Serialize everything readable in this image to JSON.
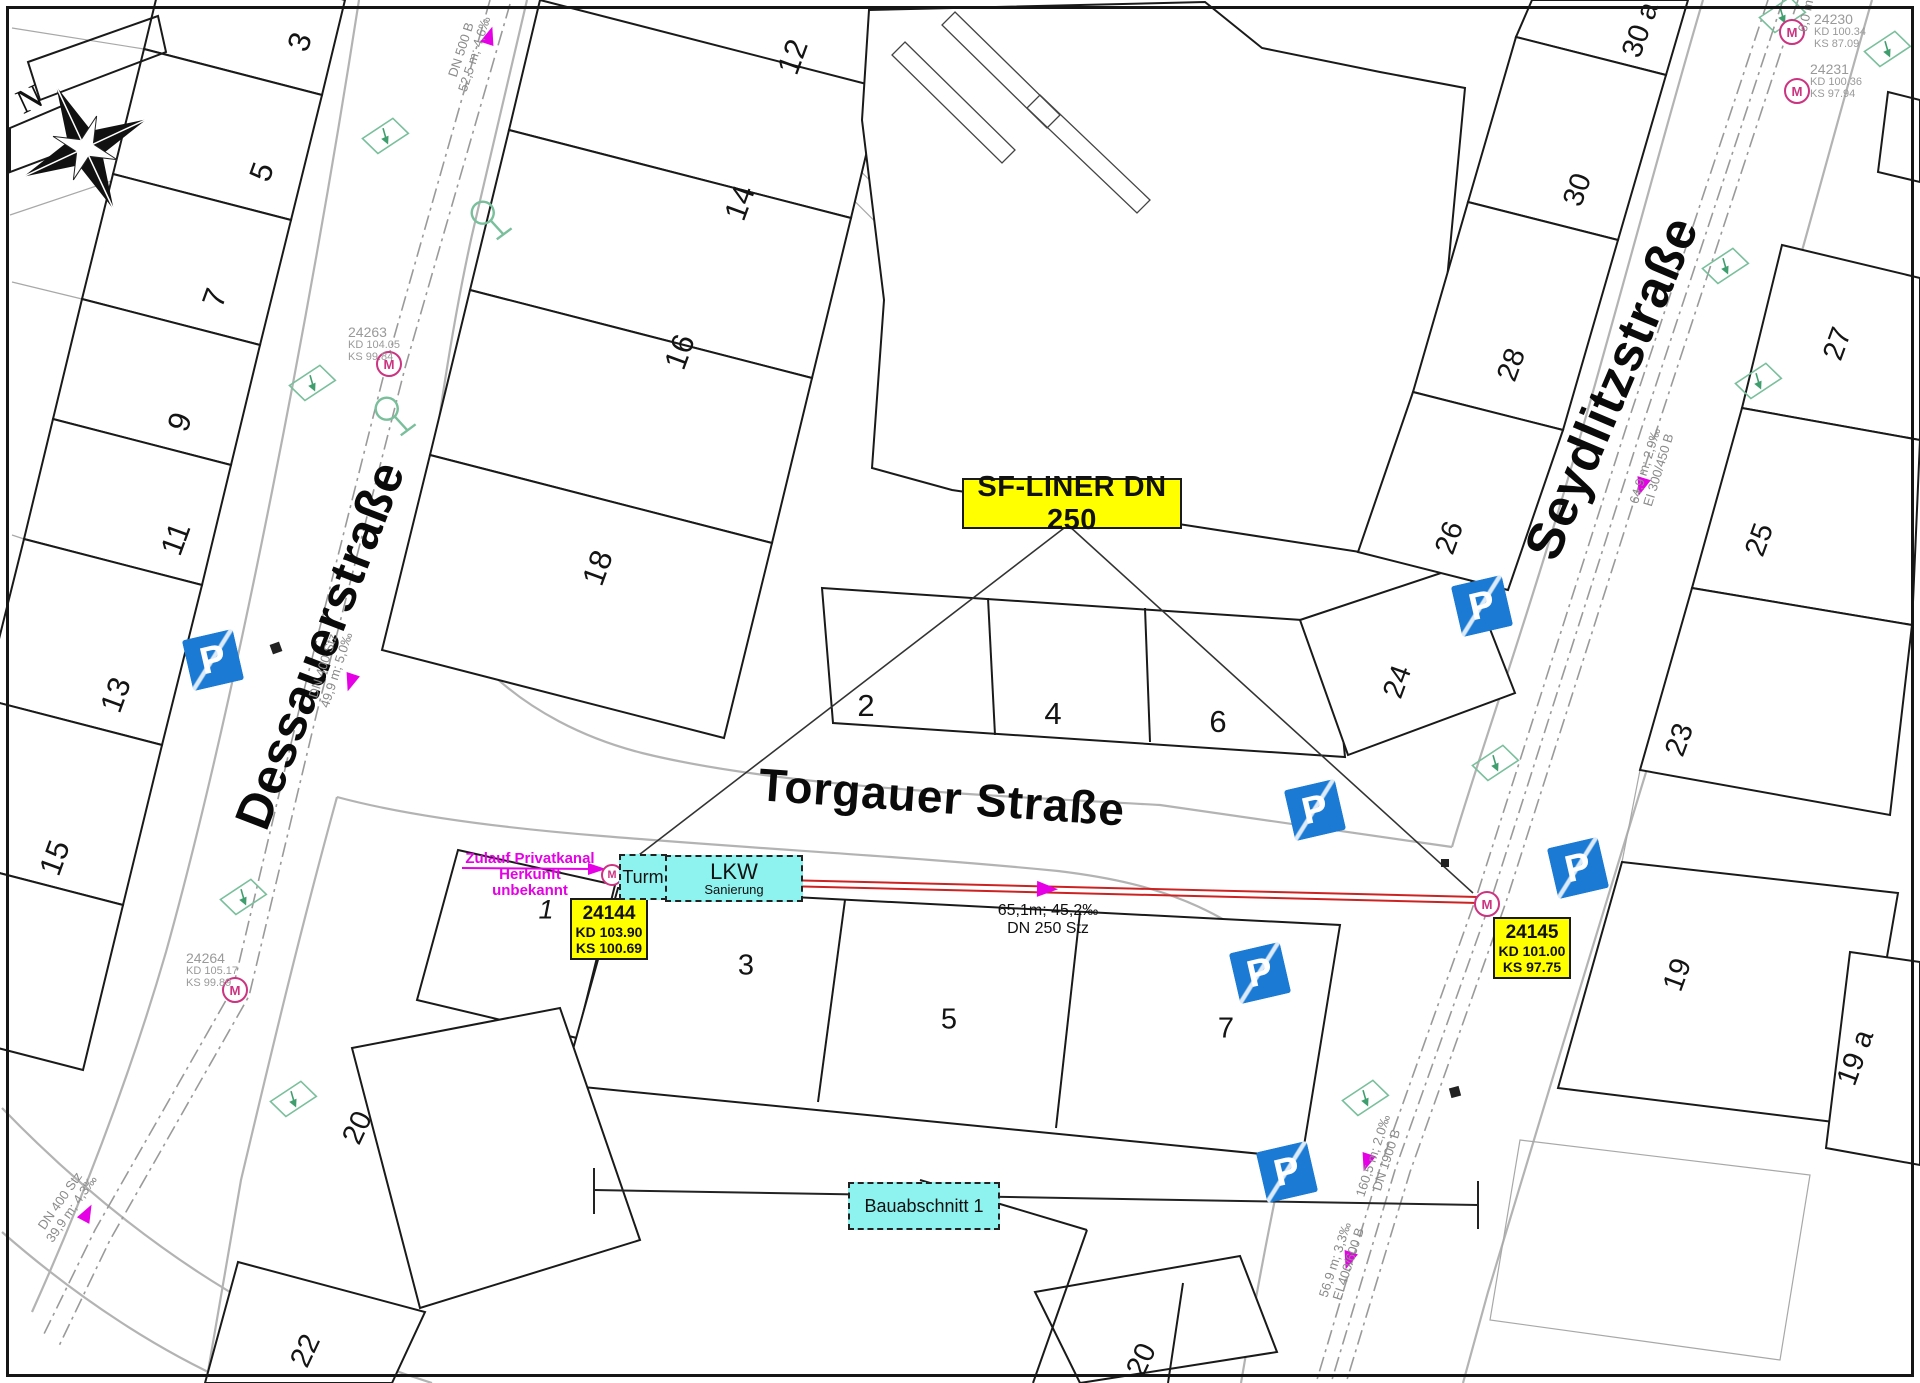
{
  "compass": {
    "label": "N"
  },
  "streets": [
    {
      "id": "dessauerstrasse",
      "name": "Dessauerstraße",
      "x": 320,
      "y": 645,
      "rot": -69,
      "size": 50
    },
    {
      "id": "torgauer-strasse",
      "name": "Torgauer Straße",
      "x": 942,
      "y": 797,
      "rot": 4,
      "size": 46
    },
    {
      "id": "seydlitzstrasse",
      "name": "Seydlitzstraße",
      "x": 1612,
      "y": 388,
      "rot": -67,
      "size": 52
    }
  ],
  "house_numbers": [
    {
      "t": "3",
      "x": 300,
      "y": 42,
      "r": -70
    },
    {
      "t": "5",
      "x": 262,
      "y": 172,
      "r": -70
    },
    {
      "t": "7",
      "x": 215,
      "y": 298,
      "r": -70
    },
    {
      "t": "9",
      "x": 180,
      "y": 422,
      "r": -70
    },
    {
      "t": "11",
      "x": 176,
      "y": 539,
      "r": -70
    },
    {
      "t": "13",
      "x": 116,
      "y": 695,
      "r": -70
    },
    {
      "t": "15",
      "x": 55,
      "y": 858,
      "r": -70
    },
    {
      "t": "12",
      "x": 793,
      "y": 57,
      "r": -70
    },
    {
      "t": "14",
      "x": 740,
      "y": 203,
      "r": -70
    },
    {
      "t": "16",
      "x": 680,
      "y": 352,
      "r": -70
    },
    {
      "t": "18",
      "x": 598,
      "y": 568,
      "r": -70
    },
    {
      "t": "2",
      "x": 866,
      "y": 706,
      "r": 0
    },
    {
      "t": "4",
      "x": 1053,
      "y": 714,
      "r": 0
    },
    {
      "t": "6",
      "x": 1218,
      "y": 722,
      "r": 0
    },
    {
      "t": "24",
      "x": 1398,
      "y": 682,
      "r": -70,
      "cls": "small"
    },
    {
      "t": "26",
      "x": 1450,
      "y": 538,
      "r": -70,
      "cls": "small"
    },
    {
      "t": "28",
      "x": 1512,
      "y": 365,
      "r": -70,
      "cls": "small"
    },
    {
      "t": "30",
      "x": 1578,
      "y": 190,
      "r": -70,
      "cls": "small"
    },
    {
      "t": "30 a",
      "x": 1641,
      "y": 30,
      "r": -70,
      "cls": "small"
    },
    {
      "t": "27",
      "x": 1838,
      "y": 344,
      "r": -70,
      "cls": "small"
    },
    {
      "t": "25",
      "x": 1760,
      "y": 540,
      "r": -70,
      "cls": "small"
    },
    {
      "t": "23",
      "x": 1680,
      "y": 740,
      "r": -70,
      "cls": "small"
    },
    {
      "t": "19",
      "x": 1678,
      "y": 975,
      "r": -70,
      "cls": "small"
    },
    {
      "t": "19 a",
      "x": 1856,
      "y": 1058,
      "r": -70,
      "cls": "small"
    },
    {
      "t": "1",
      "x": 546,
      "y": 910,
      "r": 0,
      "cls": "italic"
    },
    {
      "t": "3",
      "x": 746,
      "y": 966,
      "r": 0,
      "cls": "small"
    },
    {
      "t": "5",
      "x": 949,
      "y": 1020,
      "r": 0,
      "cls": "small"
    },
    {
      "t": "7",
      "x": 1226,
      "y": 1029,
      "r": 0,
      "cls": "small"
    },
    {
      "t": "20",
      "x": 358,
      "y": 1128,
      "r": -65,
      "cls": "small"
    },
    {
      "t": "22",
      "x": 306,
      "y": 1351,
      "r": -65,
      "cls": "small"
    },
    {
      "t": "20",
      "x": 1142,
      "y": 1360,
      "r": -65,
      "cls": "small"
    }
  ],
  "manholes": [
    {
      "id": "24263",
      "letter": "M",
      "kd": "KD 104.05",
      "ks": "KS 99.84",
      "cx": 387,
      "cy": 362,
      "lx": 348,
      "ly": 325,
      "size": 22
    },
    {
      "id": "24264",
      "letter": "M",
      "kd": "KD 105.17",
      "ks": "KS 99.89",
      "cx": 233,
      "cy": 988,
      "lx": 186,
      "ly": 951,
      "size": 22
    },
    {
      "id": "24230",
      "letter": "M",
      "kd": "KD 100.34",
      "ks": "KS 87.09",
      "cx": 1790,
      "cy": 30,
      "lx": 1814,
      "ly": 12,
      "size": 22
    },
    {
      "id": "24231",
      "letter": "M",
      "kd": "KD 100.36",
      "ks": "KS 97.94",
      "cx": 1795,
      "cy": 89,
      "lx": 1810,
      "ly": 62,
      "size": 22
    },
    {
      "id": "",
      "letter": "M",
      "kd": "",
      "ks": "",
      "cx": 610,
      "cy": 873,
      "lx": 0,
      "ly": 0,
      "size": 18
    },
    {
      "id": "",
      "letter": "M",
      "kd": "",
      "ks": "",
      "cx": 1485,
      "cy": 902,
      "lx": 0,
      "ly": 0,
      "size": 22
    }
  ],
  "shaft_labels": [
    {
      "id": "shaft-24144",
      "lines": [
        "24144",
        "KD 103.90",
        "KS 100.69"
      ],
      "x": 570,
      "y": 898,
      "w": 74,
      "h": 58
    },
    {
      "id": "shaft-24145",
      "lines": [
        "24145",
        "KD 101.00",
        "KS 97.75"
      ],
      "x": 1493,
      "y": 917,
      "w": 74,
      "h": 58
    }
  ],
  "sf_liner": {
    "text": "SF-LINER DN 250",
    "x": 962,
    "y": 478,
    "w": 216,
    "h": 47
  },
  "cyan_boxes": [
    {
      "id": "turm-box",
      "cls": "",
      "lines": [
        "Turm"
      ],
      "x": 619,
      "y": 854,
      "w": 44,
      "h": 42
    },
    {
      "id": "lkw-box",
      "cls": "lkw",
      "lines": [
        "LKW",
        "Sanierung"
      ],
      "x": 665,
      "y": 855,
      "w": 134,
      "h": 43
    },
    {
      "id": "bauabschnitt-box",
      "cls": "",
      "lines": [
        "Bauabschnitt 1"
      ],
      "x": 848,
      "y": 1182,
      "w": 148,
      "h": 44
    }
  ],
  "zulauf": {
    "lines": [
      "Zulauf Privatkanal",
      "Herkunft unbekannt"
    ],
    "x": 530,
    "y": 868
  },
  "segment_label": {
    "lines": [
      "65,1m; 45,2‰",
      "DN 250 Stz"
    ],
    "x": 1048,
    "y": 911
  },
  "pipe_labels": [
    {
      "lines": [
        "DN 500 B",
        "52,5 m; 4,6‰"
      ],
      "x": 468,
      "y": 52,
      "r": -72
    },
    {
      "lines": [
        "DN 400 Stz",
        "49,9 m; 5,0‰"
      ],
      "x": 330,
      "y": 668,
      "r": -72
    },
    {
      "lines": [
        "DN 400 Stz",
        "39,9 m; 4,3‰"
      ],
      "x": 66,
      "y": 1205,
      "r": -55
    },
    {
      "lines": [
        "64,9 m; 2,9‰",
        "EI 300/450 B"
      ],
      "x": 1652,
      "y": 468,
      "r": -73
    },
    {
      "lines": [
        "160,5 m; 2,0‰",
        "DN 1900 B"
      ],
      "x": 1380,
      "y": 1158,
      "r": -72
    },
    {
      "lines": [
        "56,9 m; 3,3‰",
        "EI 400/600 B"
      ],
      "x": 1342,
      "y": 1262,
      "r": -72
    },
    {
      "lines": [
        "6,0 m"
      ],
      "x": 1806,
      "y": 16,
      "r": -78
    }
  ],
  "parking": {
    "letter": "P",
    "positions": [
      {
        "x": 213,
        "y": 660
      },
      {
        "x": 1482,
        "y": 606
      },
      {
        "x": 1315,
        "y": 810
      },
      {
        "x": 1260,
        "y": 973
      },
      {
        "x": 1578,
        "y": 868
      },
      {
        "x": 1287,
        "y": 1172
      }
    ]
  },
  "colors": {
    "accent_yellow": "#ffff00",
    "accent_cyan": "#8ef2ef",
    "magenta": "#e500e5",
    "manhole_pink": "#cc3380",
    "rehab_red": "#cc2222",
    "parking_blue": "#1a7ad4",
    "symbol_green": "#79bf9b",
    "street_gray": "#b3b3b3",
    "label_gray": "#8a8a8a",
    "ink": "#1a1a1a"
  }
}
